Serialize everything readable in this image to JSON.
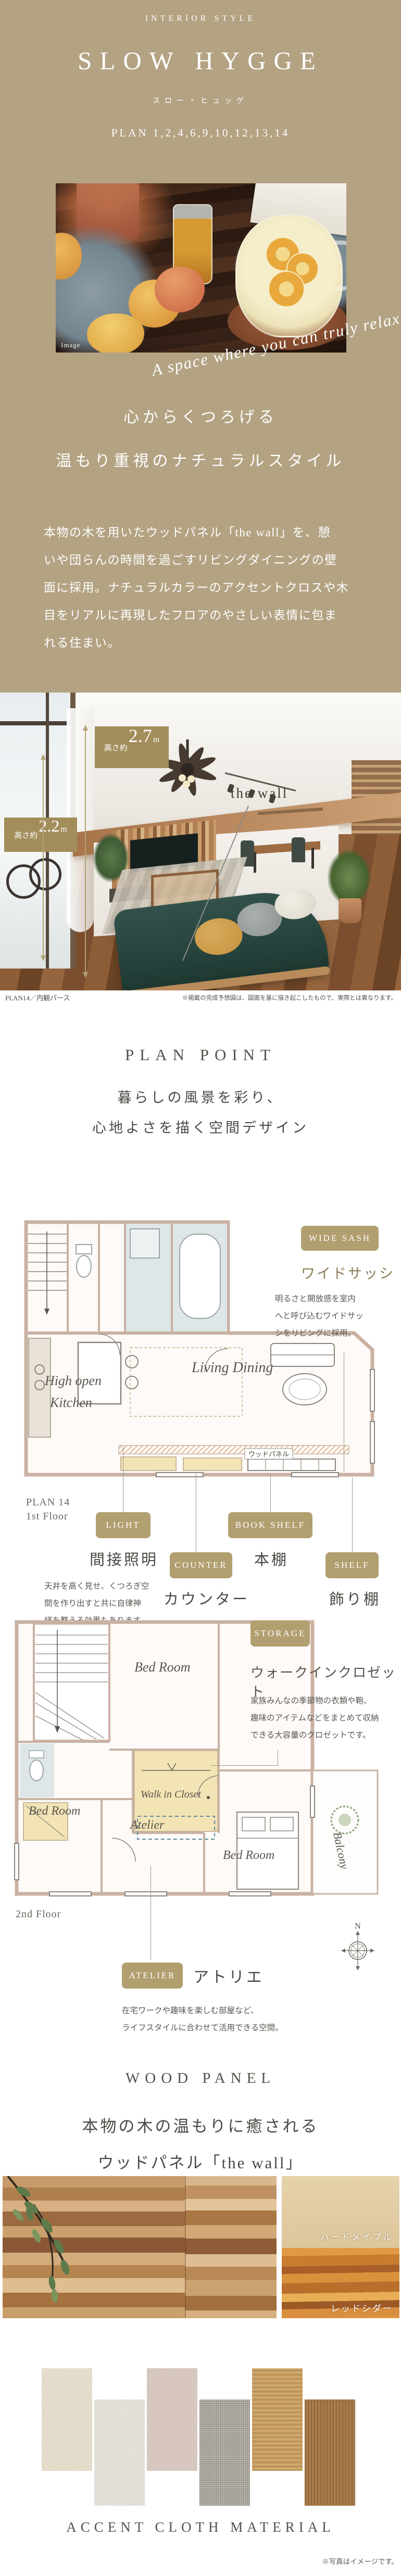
{
  "colors": {
    "tan_bg": "#b3a383",
    "photo_badge": "#a28d5b",
    "plan_badge": "#b19f70",
    "heading": "#55514b",
    "accent_arrow": "#b1a174"
  },
  "hero": {
    "eyebrow": "INTERIOR STYLE",
    "title": "SLOW HYGGE",
    "title_kana": "スロー・ヒュッゲ",
    "plans": "PLAN 1,2,4,6,9,10,12,13,14",
    "photo_tag": "Image",
    "script_text": "A space where you can truly relax.",
    "heading_line1": "心からくつろげる",
    "heading_line2": "温もり重視のナチュラルスタイル",
    "body": "本物の木を用いたウッドパネル「the wall」を、憩\nいや団らんの時間を過ごすリビングダイニングの壁\n面に採用。ナチュラルカラーのアクセントクロスや木\n目をリアルに再現したフロアのやさしい表情に包ま\nれる住まい。"
  },
  "render": {
    "badge27": {
      "prefix": "高さ約",
      "value": "2.7",
      "unit": "m"
    },
    "badge22": {
      "prefix": "高さ約",
      "value": "2.2",
      "unit": "m"
    },
    "wall_label": "the wall",
    "caption_left": "PLAN14／内観パース",
    "caption_right": "※掲載の完成予想図は、図面を基に描き起こしたもので、実際とは異なります。"
  },
  "plan_point": {
    "heading": "PLAN POINT",
    "sub1": "暮らしの風景を彩り、",
    "sub2": "心地よさを描く空間デザイン"
  },
  "floor1": {
    "plan_label_line1": "PLAN 14",
    "plan_label_line2": "1st Floor",
    "rooms": {
      "kitchen_line1": "High open",
      "kitchen_line2": "Kitchen",
      "living": "Living Dining",
      "wood_panel": "ウッドパネル"
    },
    "wide_sash": {
      "badge": "WIDE SASH",
      "title": "ワイドサッシ",
      "desc": "明るさと開放感を室内\nへと呼び込むワイドサッ\nシをリビングに採用。"
    },
    "features": [
      {
        "badge": "LIGHT",
        "title": "間接照明",
        "desc": "天井を高く見せ、くつろぎ空\n間を作り出すと共に自律神\n経を整える効果もあります。"
      },
      {
        "badge": "COUNTER",
        "title": "カウンター"
      },
      {
        "badge": "BOOK SHELF",
        "title": "本棚"
      },
      {
        "badge": "SHELF",
        "title": "飾り棚"
      }
    ]
  },
  "floor2": {
    "floor_label": "2nd Floor",
    "compass": "N",
    "rooms": {
      "bed": "Bed Room",
      "wic": "Walk in Closet",
      "atelier": "Atelier",
      "balcony": "Balcony"
    },
    "storage": {
      "badge": "STORAGE",
      "title": "ウォークインクロゼット",
      "desc": "家族みんなの季節物の衣類や鞄、\n趣味のアイテムなどをまとめて収納\nできる大容量のクロゼットです。"
    },
    "atelier": {
      "badge": "ATELIER",
      "title": "アトリエ",
      "desc": "在宅ワークや趣味を楽しむ部屋など、\nライフスタイルに合わせて活用できる空間。"
    }
  },
  "wood": {
    "heading": "WOOD PANEL",
    "sub1": "本物の木の温もりに癒される",
    "sub2": "ウッドパネル「the wall」",
    "maple_label": "ハードメイプル",
    "cedar_label": "レッドシダー"
  },
  "cloth": {
    "heading": "ACCENT CLOTH MATERIAL",
    "note": "※写真はイメージです。",
    "swatch_colors": [
      "#e6decb",
      "#e4e1da",
      "#d7c6bf",
      "#b6b1a9",
      "#c79d60",
      "#a97c4a"
    ]
  }
}
